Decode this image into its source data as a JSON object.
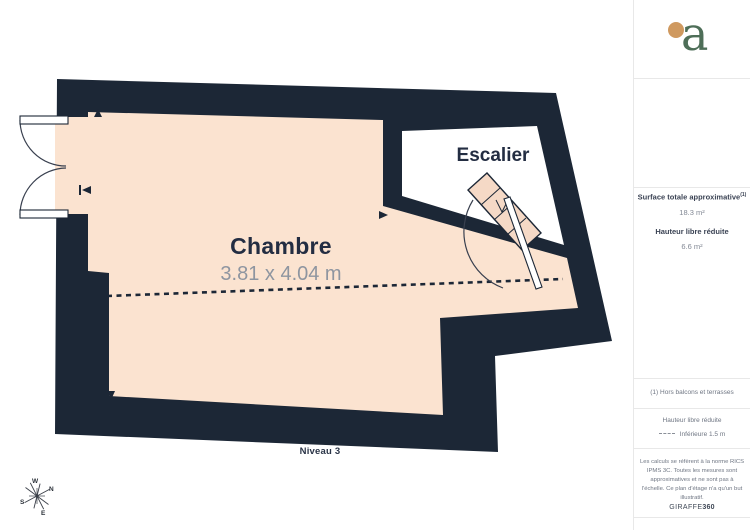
{
  "plan": {
    "room": {
      "name": "Chambre",
      "dimensions": "3.81 x 4.04 m"
    },
    "stairs_label": "Escalier",
    "level_label": "Niveau 3",
    "compass": {
      "n": "N",
      "s": "S",
      "e": "E",
      "w": "W"
    }
  },
  "sidebar": {
    "logo_letter": "a",
    "metrics": {
      "surface_label": "Surface totale approximative",
      "surface_note_ref": "(1)",
      "surface_value": "18.3 m²",
      "height_label": "Hauteur libre réduite",
      "height_value": "6.6 m²"
    },
    "footnote": "(1) Hors balcons et terrasses",
    "legend": {
      "title": "Hauteur libre réduite",
      "item": "Inférieure 1.5 m"
    },
    "disclaimer_lines": [
      "Les calculs se réfèrent à la norme RICS",
      "IPMS 3C. Toutes les mesures sont",
      "approximatives et ne sont pas à",
      "l'échelle. Ce plan d'étage n'a qu'un but",
      "illustratif."
    ],
    "brand": {
      "name": "GIRAFFE",
      "suffix": "360"
    }
  },
  "colors": {
    "wall": "#1c2736",
    "floor": "#fbe3d0",
    "stair_tread": "#f5d9c6",
    "logo_green": "#4e6e58",
    "logo_orange": "#cf995f",
    "text_dark": "#232d42",
    "text_gray": "#8e95a0"
  }
}
